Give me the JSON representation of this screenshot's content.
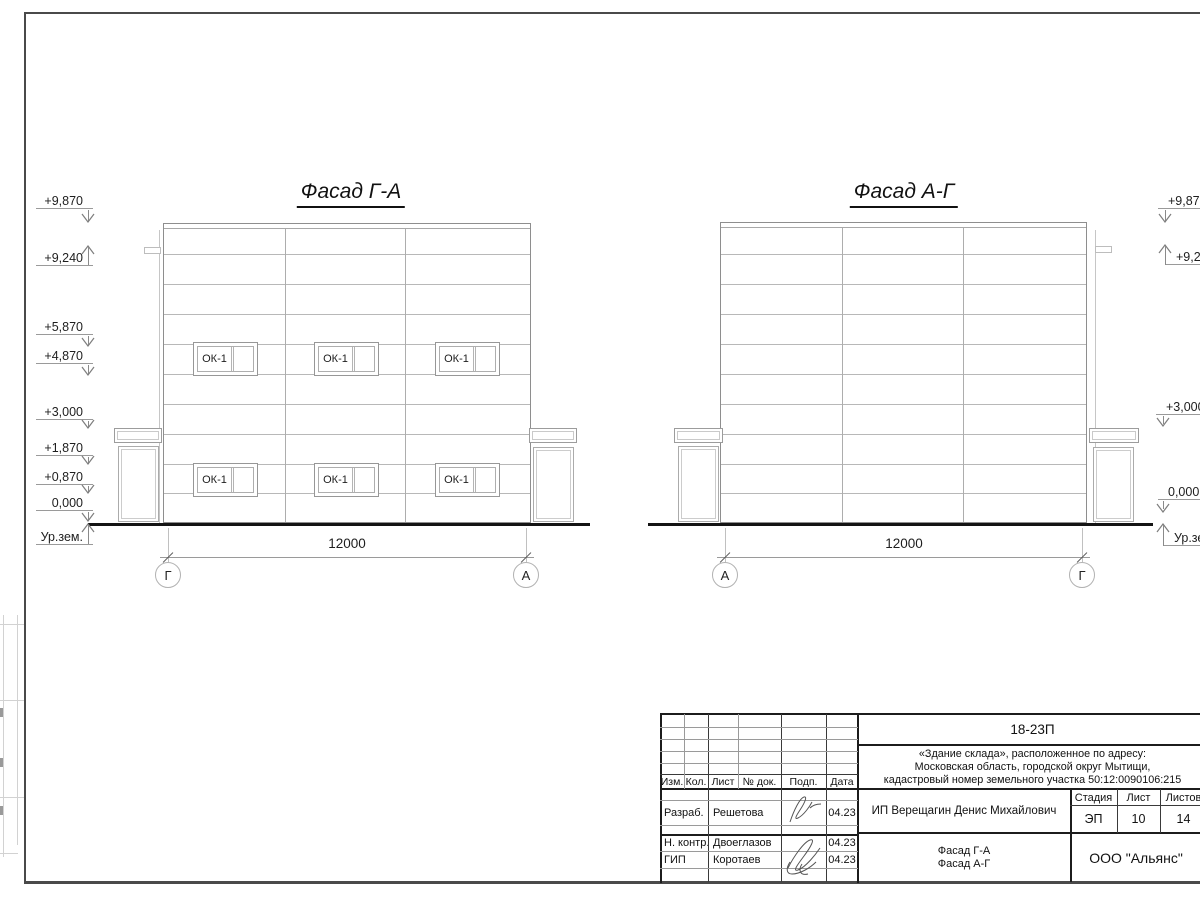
{
  "sheet": {
    "ink_color": "#1c1c1c",
    "light_line_color": "#b8b8b8"
  },
  "facade_left": {
    "title": "Фасад Г-А",
    "dimension": "12000",
    "axis_start": "Г",
    "axis_end": "А",
    "window_label": "ОК-1"
  },
  "facade_right": {
    "title": "Фасад А-Г",
    "dimension": "12000",
    "axis_start": "А",
    "axis_end": "Г"
  },
  "elevations": {
    "left": [
      "+9,870",
      "+9,240",
      "+5,870",
      "+4,870",
      "+3,000",
      "+1,870",
      "+0,870",
      "0,000",
      "Ур.зем."
    ],
    "right": [
      "+9,870",
      "+9,240",
      "+3,000",
      "0,000",
      "Ур.зем."
    ]
  },
  "stamp": {
    "doc_number": "18-23П",
    "object_lines": [
      "«Здание склада», расположенное по адресу:",
      "Московская область, городской округ Мытищи,",
      "кадастровый номер земельного участка 50:12:0090106:215"
    ],
    "col_headers": [
      "Изм.",
      "Кол.",
      "Лист",
      "№ док.",
      "Подп.",
      "Дата"
    ],
    "signers": [
      {
        "role": "Разраб.",
        "name": "Решетова",
        "date": "04.23"
      },
      {
        "role": "Н. контр.",
        "name": "Двоеглазов",
        "date": "04.23"
      },
      {
        "role": "ГИП",
        "name": "Коротаев",
        "date": "04.23"
      }
    ],
    "client": "ИП Верещагин Денис Михайлович",
    "stage_header": "Стадия",
    "sheet_header": "Лист",
    "sheets_header": "Листов",
    "stage": "ЭП",
    "sheet": "10",
    "sheets": "14",
    "drawing_titles": [
      "Фасад Г-А",
      "Фасад А-Г"
    ],
    "company": "ООО \"Альянс\""
  }
}
